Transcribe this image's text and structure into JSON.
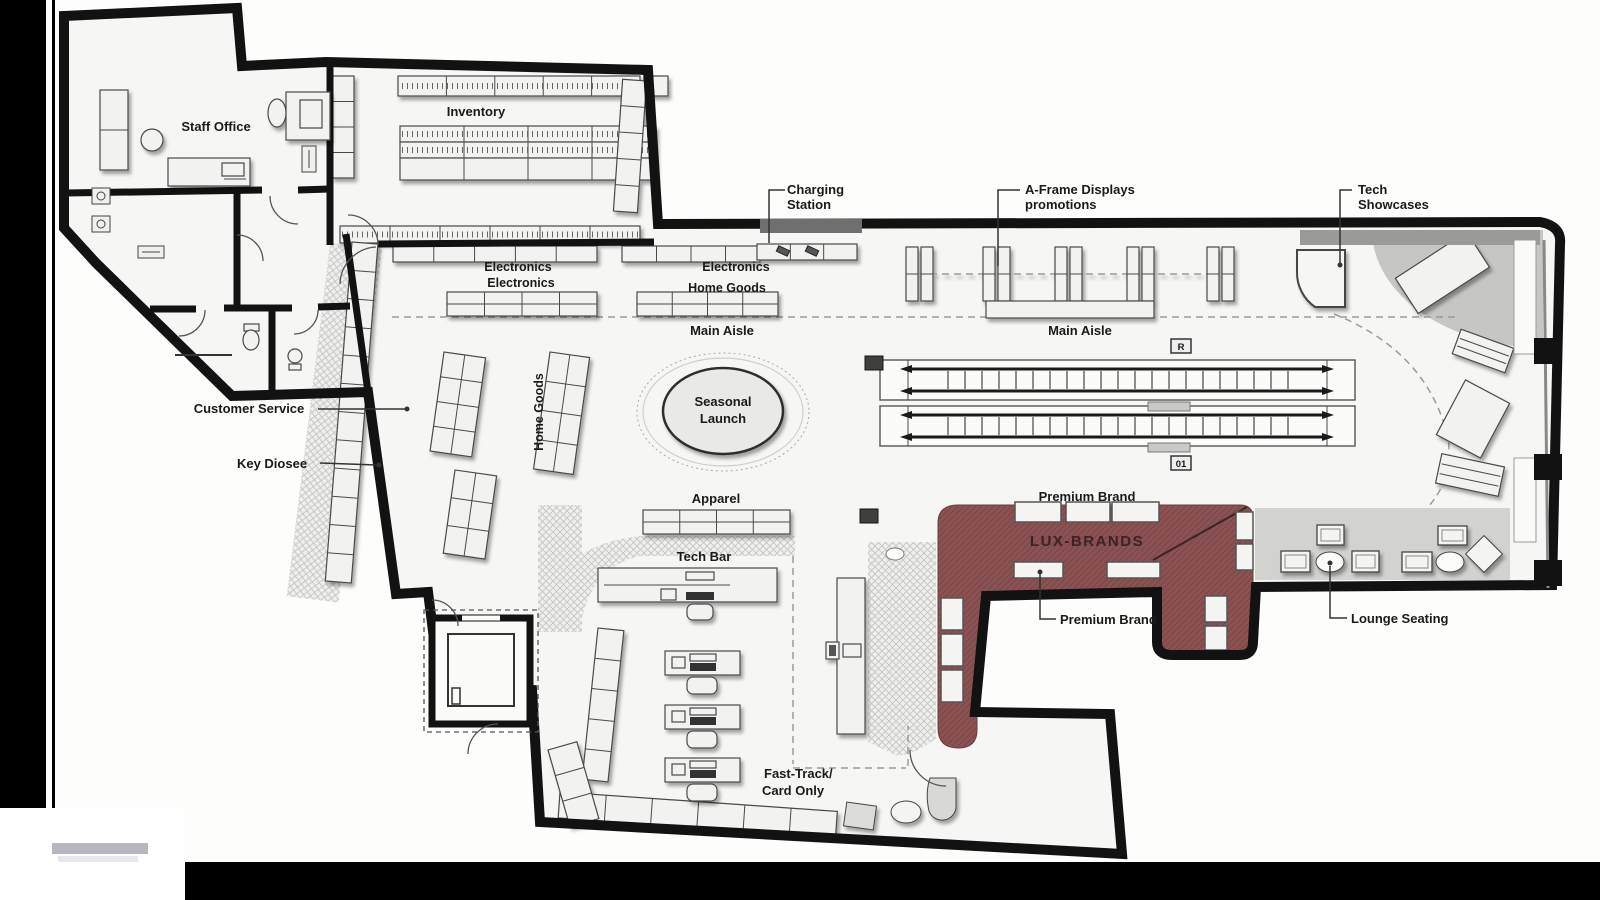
{
  "figure": "retail-store-floor-plan",
  "areas": {
    "staff_office": "Staff Office",
    "inventory": "Inventory",
    "electronics_wall_left": "Electronics",
    "electronics_wall_right": "Electronics",
    "electronics_floor": "Electronics",
    "home_goods_floor": "Home Goods",
    "home_goods_wall": "Home Goods",
    "main_aisle_west": "Main Aisle",
    "main_aisle_east": "Main Aisle",
    "seasonal_launch": [
      "Seasonal",
      "Launch"
    ],
    "apparel": "Apparel",
    "tech_bar": "Tech Bar",
    "premium_brand": "Premium Brand",
    "lux_brands": "LUX-BRANDS",
    "fast_track": [
      "Fast-Track/",
      "Card Only"
    ]
  },
  "callouts": {
    "charging_station": [
      "Charging",
      "Station"
    ],
    "a_frame": [
      "A-Frame Displays",
      "promotions"
    ],
    "tech_showcases": [
      "Tech",
      "Showcases"
    ],
    "customer_service": "Customer Service",
    "key_diosee": "Key Diosee",
    "premium_brand": "Premium Brand",
    "lounge_seating": "Lounge Seating"
  },
  "escalator_tags": {
    "up": "R",
    "down": "01"
  },
  "icons": [
    "phone-icon",
    "toilet-icon",
    "cart-icon",
    "door-tag-icon",
    "column-icon"
  ],
  "colors": {
    "background": "#000000",
    "canvas": "#fdfdfc",
    "floor": "#f6f6f4",
    "wall": "#121212",
    "lux_area": "#8a5252",
    "lux_text": "#3c2323",
    "lounge_gray": "#d2d2cf",
    "corner_gray": "#c6c6c4",
    "hatch_gray": "#c4c4c2",
    "charging_wall_gray": "#6f6f6f"
  }
}
